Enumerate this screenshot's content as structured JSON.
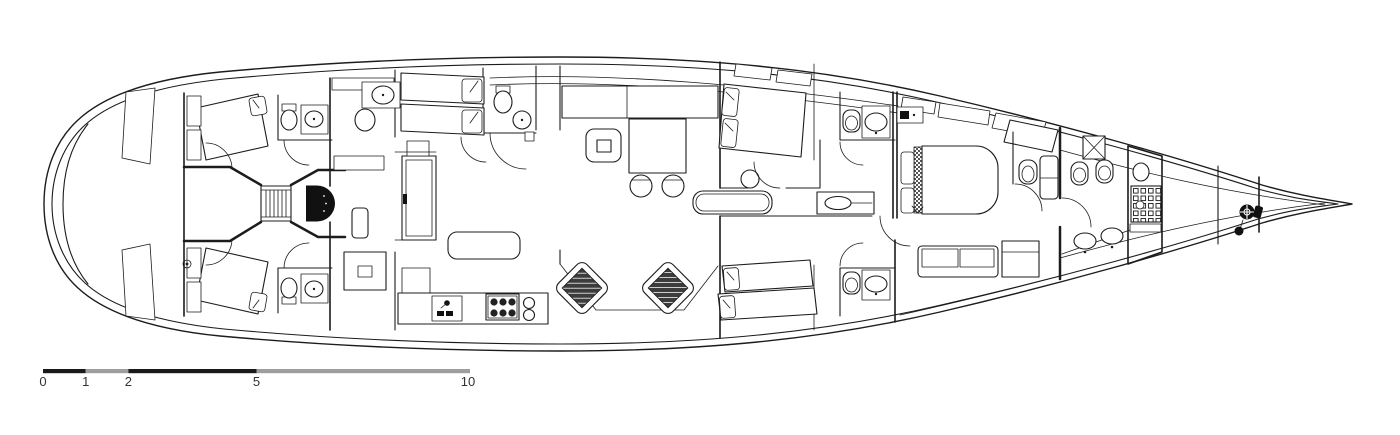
{
  "drawing": {
    "background": "#ffffff",
    "line_color": "#1c1c1c",
    "dark_fill": "#111111",
    "hatch_fill": "#3c3c3c"
  },
  "scale_bar": {
    "unit_labels": [
      "0",
      "1",
      "2",
      "5",
      "10"
    ],
    "dark_color": "#1a1a1a",
    "light_color": "#9e9e9e",
    "label_color": "#333333"
  }
}
